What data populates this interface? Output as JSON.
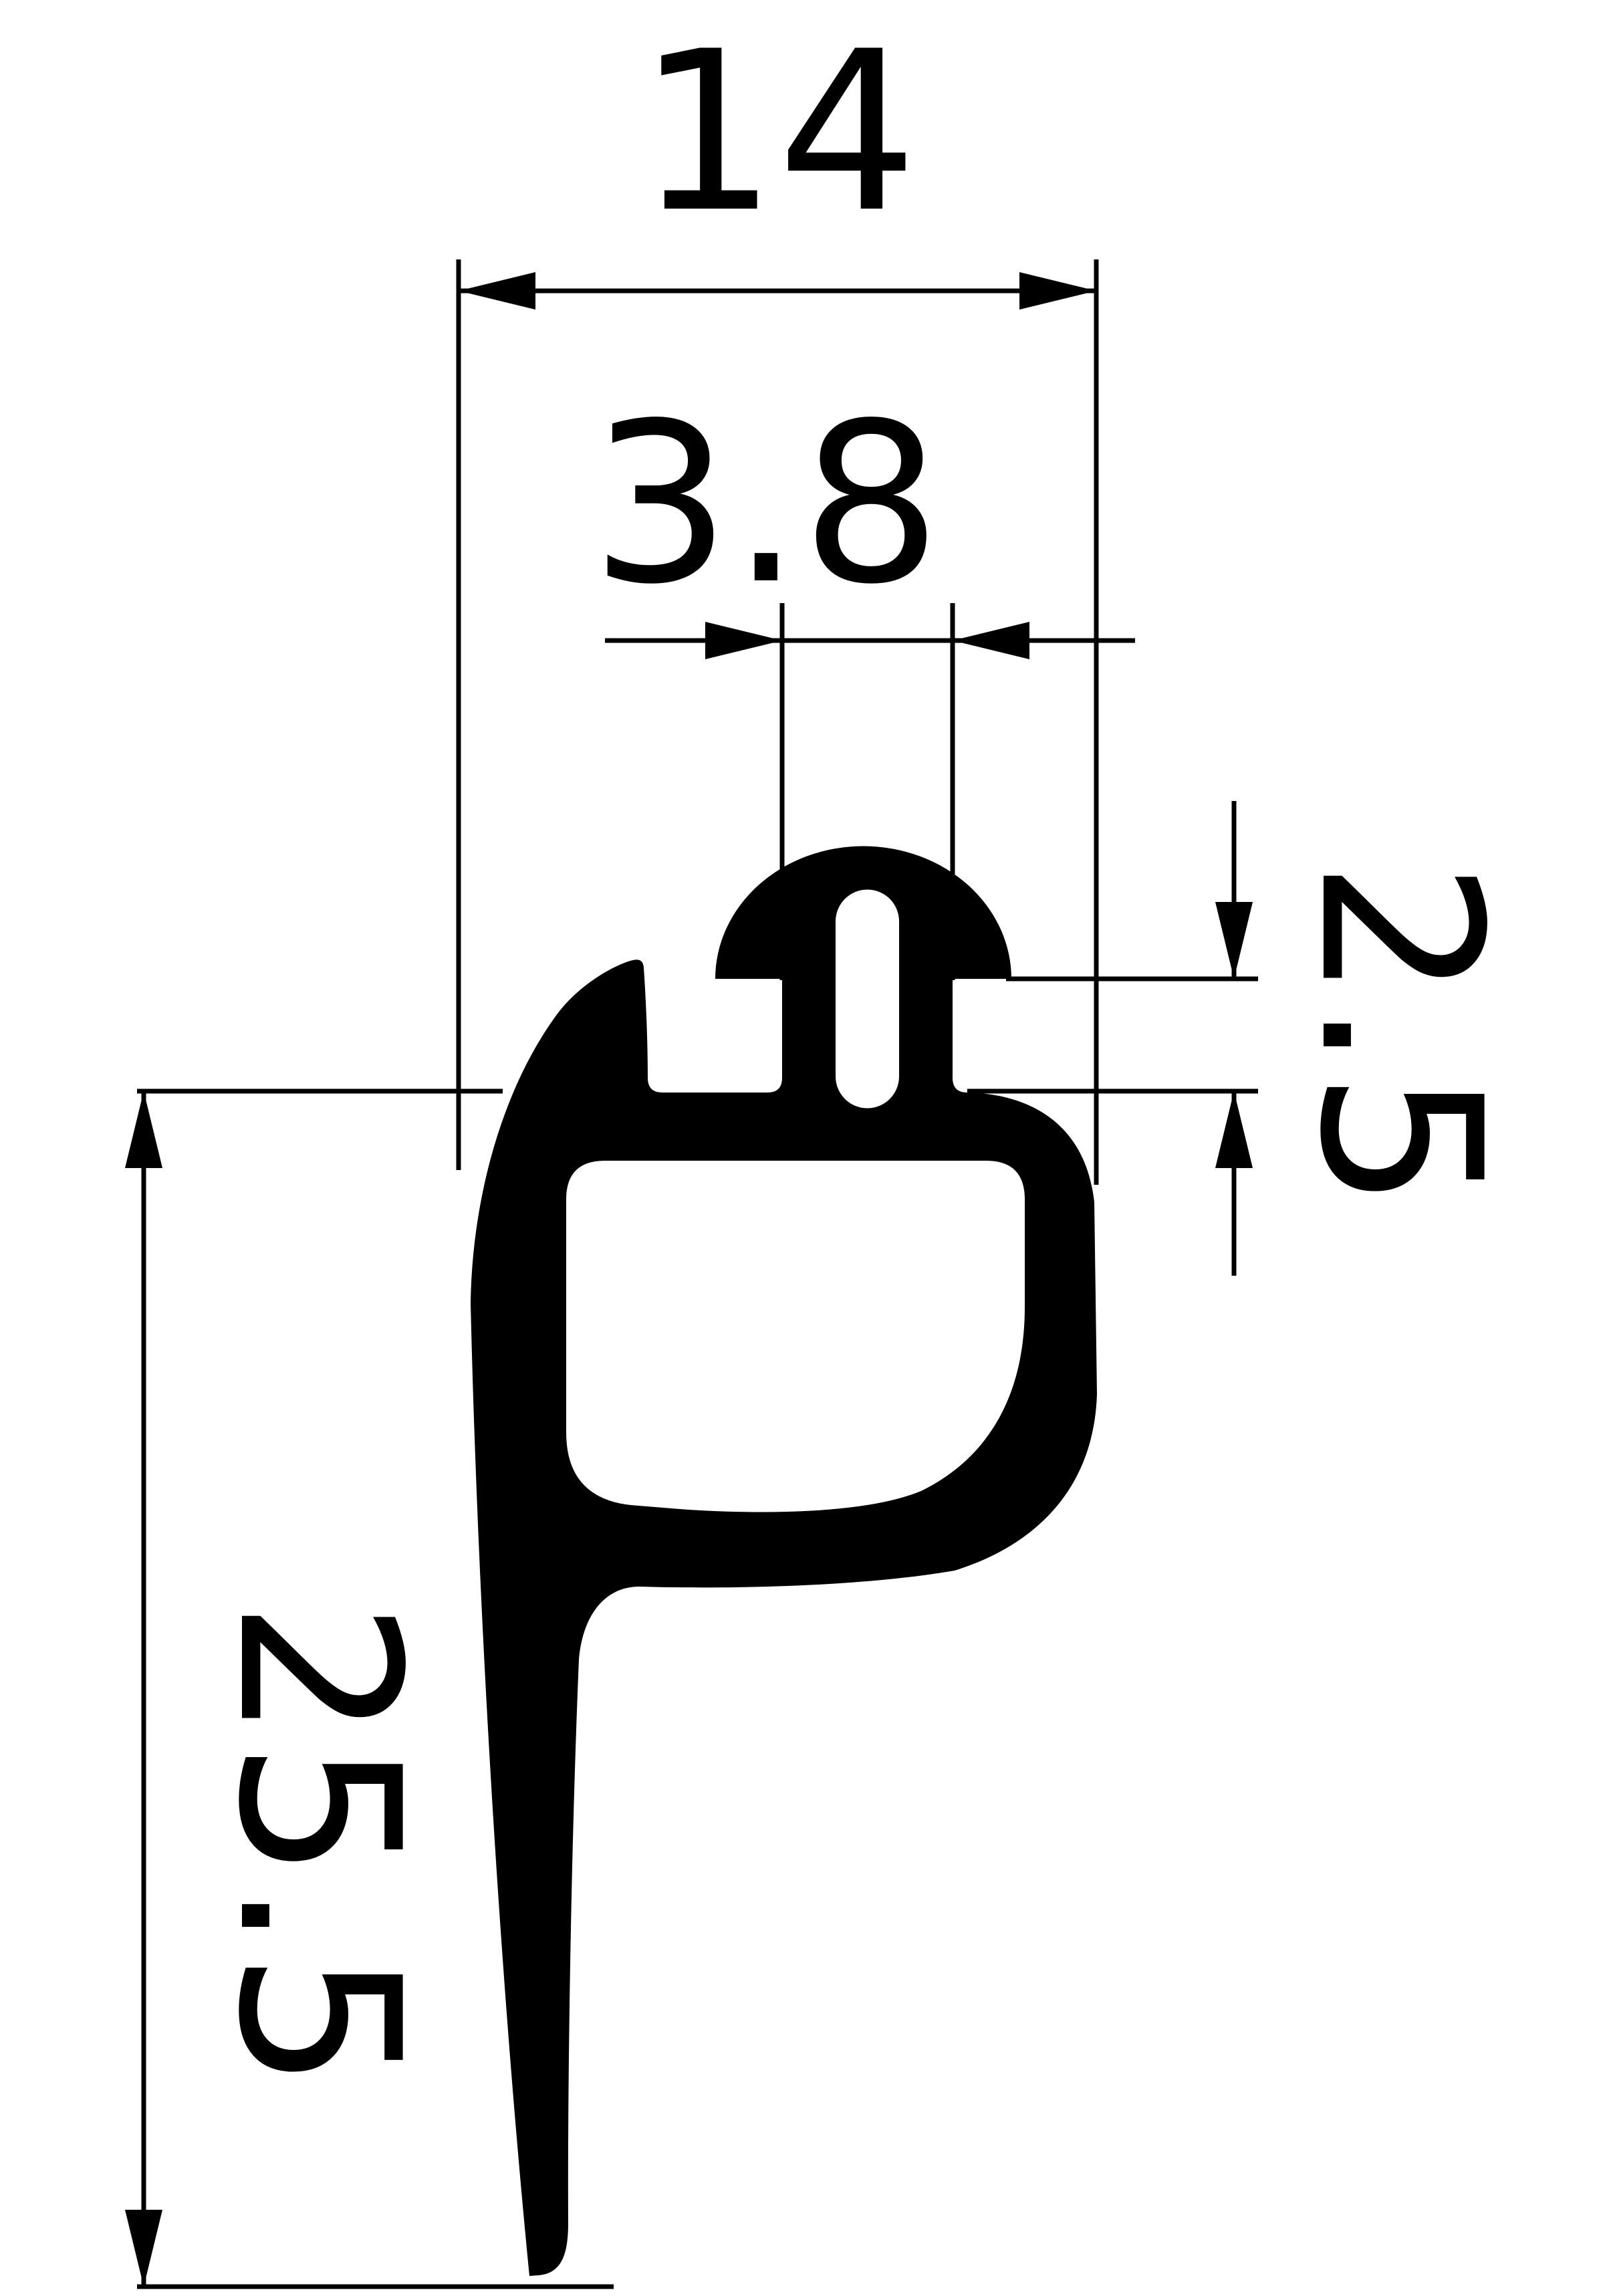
{
  "drawing": {
    "background": "#ffffff",
    "line_color": "#000000",
    "profile_color": "#000000",
    "dimensions": {
      "top_width": {
        "value": "14"
      },
      "stem_width": {
        "value": "3.8"
      },
      "lip_height": {
        "value": "2.5"
      },
      "overall_height": {
        "value": "25.5"
      }
    }
  }
}
